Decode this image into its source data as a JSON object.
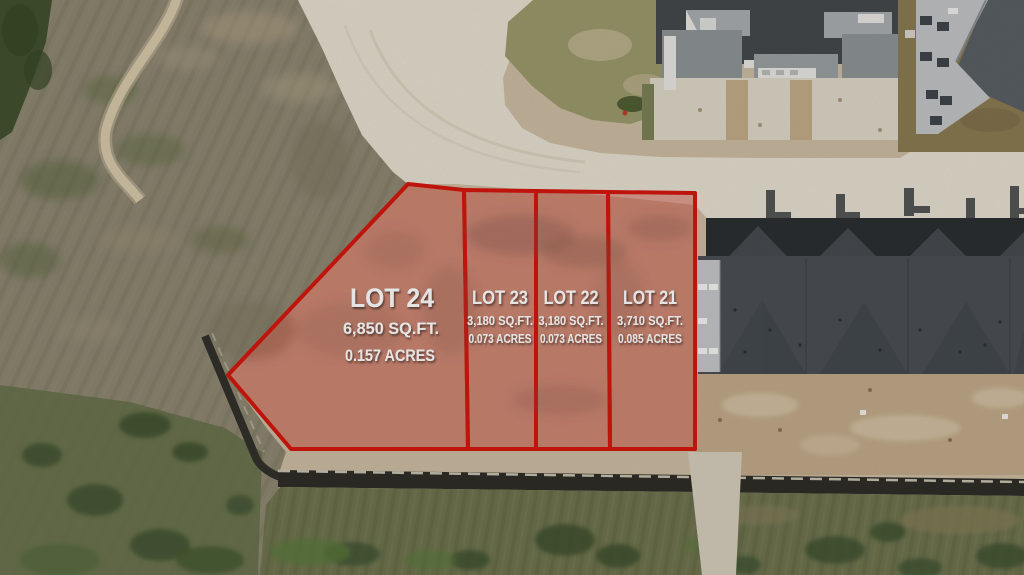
{
  "lots": [
    {
      "id": "lot-24",
      "name": "LOT 24",
      "sqft": "6,850 SQ.FT.",
      "acres": "0.157 ACRES"
    },
    {
      "id": "lot-23",
      "name": "LOT 23",
      "sqft": "3,180 SQ.FT.",
      "acres": "0.073 ACRES"
    },
    {
      "id": "lot-22",
      "name": "LOT 22",
      "sqft": "3,180 SQ.FT.",
      "acres": "0.073 ACRES"
    },
    {
      "id": "lot-21",
      "name": "LOT 21",
      "sqft": "3,710 SQ.FT.",
      "acres": "0.085 ACRES"
    }
  ],
  "colors": {
    "lot_border": "#d5170e",
    "lot_fill": "rgba(206,32,22,0.34)",
    "label_text": "#ffffff"
  }
}
